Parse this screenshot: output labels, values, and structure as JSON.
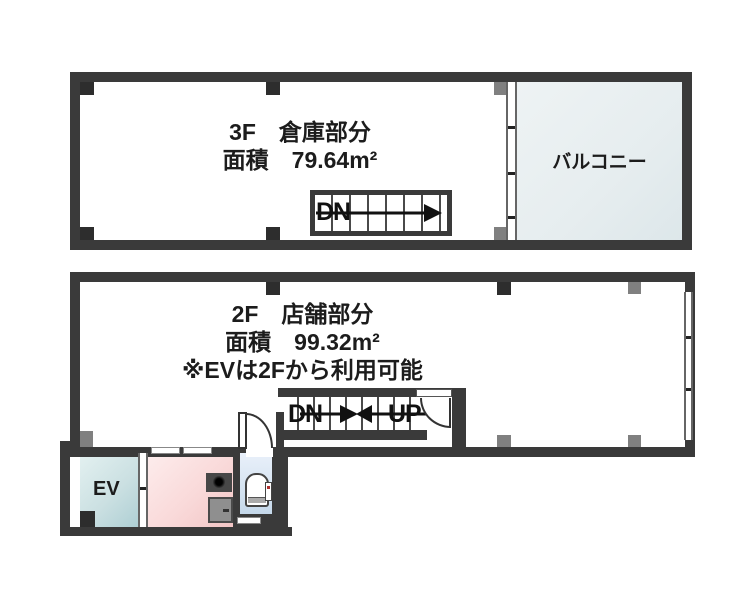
{
  "floor3": {
    "name_label": "3F　倉庫部分",
    "area_label": "面積　79.64m²",
    "balcony_label": "バルコニー",
    "stair_direction_label": "DN"
  },
  "floor2": {
    "name_label": "2F　店舗部分",
    "area_label": "面積　99.32m²",
    "note_label": "※EVは2Fから利用可能",
    "stair_down_label": "DN",
    "stair_up_label": "UP",
    "elevator_label": "EV"
  },
  "colors": {
    "wall": "#3a3a3a",
    "pillar_black": "#2d2d2d",
    "pillar_gray": "#808080",
    "balcony_fill": "#e6edef",
    "elevator_fill": "#cbe0e2",
    "kitchen_fill": "#f9d9d9",
    "toilet_fill": "#d5e3f1",
    "text": "#1c1c1c"
  }
}
